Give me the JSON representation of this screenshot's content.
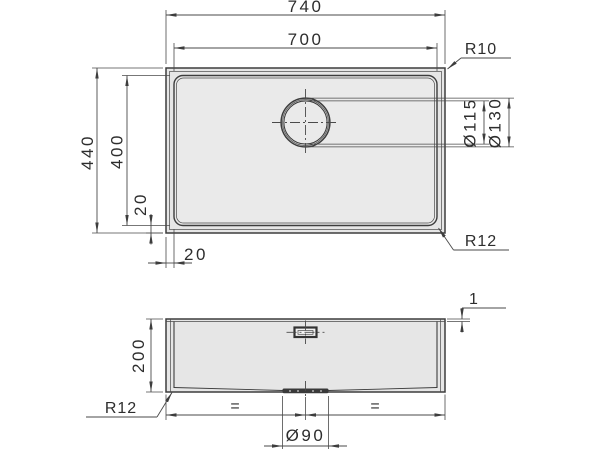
{
  "colors": {
    "background": "#ffffff",
    "line": "#3d3d3d",
    "sink_fill": "#e6e6e6",
    "bowl_fill": "#eaeaea",
    "text": "#2d2d2d"
  },
  "top_view": {
    "overall_width": "740",
    "bowl_width": "700",
    "overall_depth": "440",
    "bowl_depth": "400",
    "left_offset": "20",
    "bottom_offset": "20",
    "corner_radius_top": "R10",
    "corner_radius_bottom": "R12",
    "drain_dia_inner": "Ø115",
    "drain_dia_outer": "Ø130"
  },
  "front_view": {
    "rim_height": "1",
    "bowl_height": "200",
    "corner_radius": "R12",
    "drain_dia": "Ø90",
    "equal_spacing_left": "=",
    "equal_spacing_right": "="
  }
}
